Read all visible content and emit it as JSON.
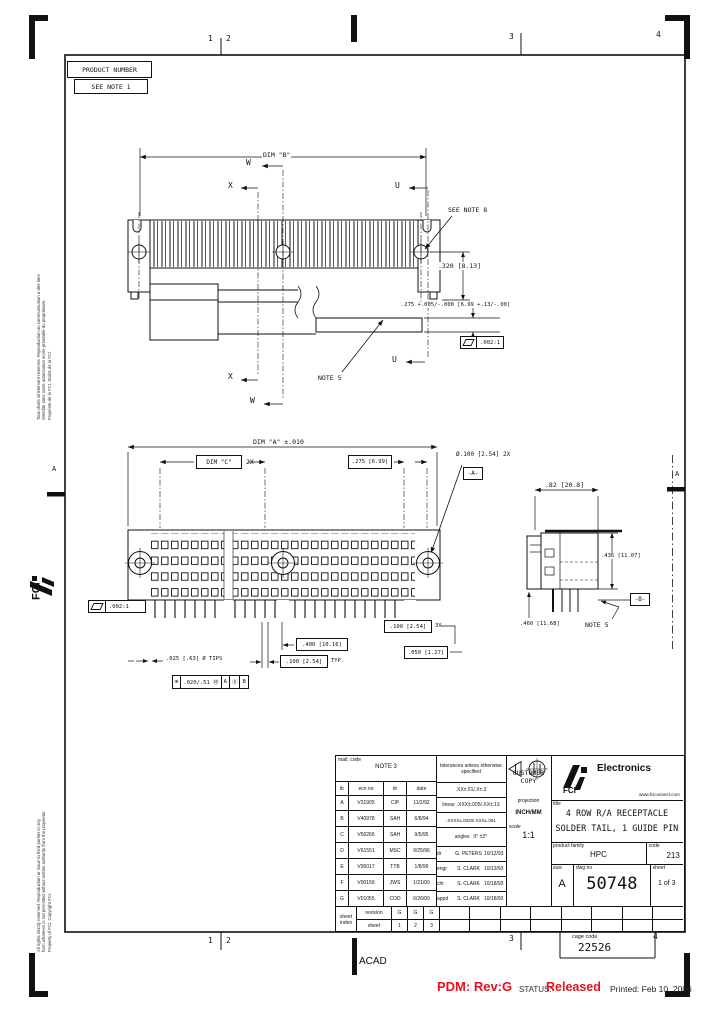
{
  "page": {
    "zones_top": [
      "1",
      "2",
      "3",
      "4"
    ],
    "zones_bottom": [
      "1",
      "2",
      "3",
      "4"
    ],
    "zone_left": "A",
    "zone_right": "A",
    "acad": "ACAD",
    "cage_code_label": "cage code",
    "cage_code": "22526"
  },
  "footer": {
    "pdm": "PDM: Rev:G",
    "status_label": "STATUS:",
    "status_value": "Released",
    "printed": "Printed: Feb 10, 2006",
    "accent_red": "#e8101d"
  },
  "margin": {
    "notice_fr_1": "Tous droits strictement reserves. Reproduction ou communication a des tiers",
    "notice_fr_2": "interdite sans notre autorisation ecrite prealable du proprietaire.",
    "notice_fr_3": "Propriete de la FCI.  Droits de la FCI.",
    "notice_en_1": "All rights strictly reserved. Reproduction or issue to third parties in any",
    "notice_en_2": "form whatever is not permitted without written authority from the proprietor.",
    "notice_en_3": "Property of FCI.  Copyright FCI.",
    "logo_text": "FCI"
  },
  "product_box": {
    "line1": "PRODUCT NUMBER",
    "line2": "SEE NOTE 1"
  },
  "top_view": {
    "dim_b": "DIM \"B\"",
    "w": "W",
    "x": "X",
    "u": "U",
    "see_note_8": "SEE NOTE 8",
    "dim_320": ".320 [8.13]",
    "dim_275_tol": ".275 +.005/-.000 [6.99 +.13/-.00]",
    "flag_value": ".002:1",
    "note_5": "NOTE 5",
    "u2": "U",
    "x2": "X",
    "w2": "W"
  },
  "front_view": {
    "dim_a": "DIM \"A\" ±.010",
    "dim_c": "DIM \"C\"",
    "dim_c_qty": "2X",
    "dim_275": ".275 [6.99]",
    "dia_100": "Ø.100 [2.54] 2X",
    "datum_a": "-A-",
    "flag_value": ".002:1",
    "dim_400": ".400 [10.16]",
    "dim_100_3x": ".100 [2.54]",
    "dim_100_3x_qty": "3X",
    "dim_050": ".050 [1.27]",
    "dim_100_typ": ".100 [2.54]",
    "dim_100_typ_suffix": "TYP.",
    "dim_025": ".025 [.63] Ø TIPS",
    "fcf_sym": "⊕",
    "fcf_tol": ".020/.51 Ⓜ",
    "fcf_d1": "A",
    "fcf_d2": "Ⓢ",
    "fcf_d3": "B"
  },
  "side_view": {
    "dim_82": ".82 [20.8]",
    "dim_436": ".436 [11.07]",
    "dim_460": ".460 [11.68]",
    "note_5": "NOTE 5",
    "datum_b": "-B-"
  },
  "title_block": {
    "matl_code_label": "matl. code",
    "matl_code": "NOTE 3",
    "rev_headers": [
      "ltr",
      "ecn no",
      "dr",
      "date"
    ],
    "revisions": [
      {
        "ltr": "A",
        "ecn": "V31905",
        "dr": "CIP",
        "date": "11/2/92"
      },
      {
        "ltr": "B",
        "ecn": "V40978",
        "dr": "SAH",
        "date": "6/8/94"
      },
      {
        "ltr": "C",
        "ecn": "V50266",
        "dr": "SAH",
        "date": "9/5/95"
      },
      {
        "ltr": "D",
        "ecn": "V61551",
        "dr": "MSC",
        "date": "9/25/96"
      },
      {
        "ltr": "E",
        "ecn": "V95017",
        "dr": "TTB",
        "date": "1/8/99"
      },
      {
        "ltr": "F",
        "ecn": "V00159",
        "dr": "JWS",
        "date": "1/21/00"
      },
      {
        "ltr": "G",
        "ecn": "V01055",
        "dr": "COD",
        "date": "6/26/00"
      }
    ],
    "tol_header": "tolerances unless otherwise specified",
    "linear_label": "linear",
    "tol_rows": [
      ".XX±.01/.X±.3",
      ".XXX±.005/.XX±.13",
      ".XXXX±.0020/.XXX±.051"
    ],
    "angles_label": "angles",
    "angles_value": "0° ±2°",
    "approvals": [
      {
        "role": "dr",
        "name": "G. PETERS",
        "date": "10/12/93"
      },
      {
        "role": "engr",
        "name": "S. CLARK",
        "date": "10/13/93"
      },
      {
        "role": "chr",
        "name": "S. CLARK",
        "date": "10/18/93"
      },
      {
        "role": "appd",
        "name": "S. CLARK",
        "date": "10/18/93"
      }
    ],
    "customer_copy": "CUSTOMER COPY",
    "projection_label": "projection",
    "units": "INCH/MM",
    "scale_label": "scale",
    "scale_value": "1:1",
    "brand_name": "Electronics",
    "brand_sub": "FCI",
    "brand_url": "www.fciconnect.com",
    "title_label": "title",
    "title_line1": "4 ROW R/A RECEPTACLE",
    "title_line2": "SOLDER TAIL, 1 GUIDE PIN",
    "family_label": "product family",
    "family": "HPC",
    "code_label": "code",
    "code": "213",
    "size_label": "size",
    "size": "A",
    "dwg_label": "dwg no",
    "dwg_no": "50748",
    "sheet_label": "sheet",
    "sheet": "1 of 3",
    "index_col1a": "sheet",
    "index_col1b": "index",
    "index_col2a": "revision",
    "index_col2b": "sheet",
    "index_revs": [
      "G",
      "G",
      "G"
    ],
    "index_sheets": [
      "1",
      "2",
      "3"
    ]
  }
}
